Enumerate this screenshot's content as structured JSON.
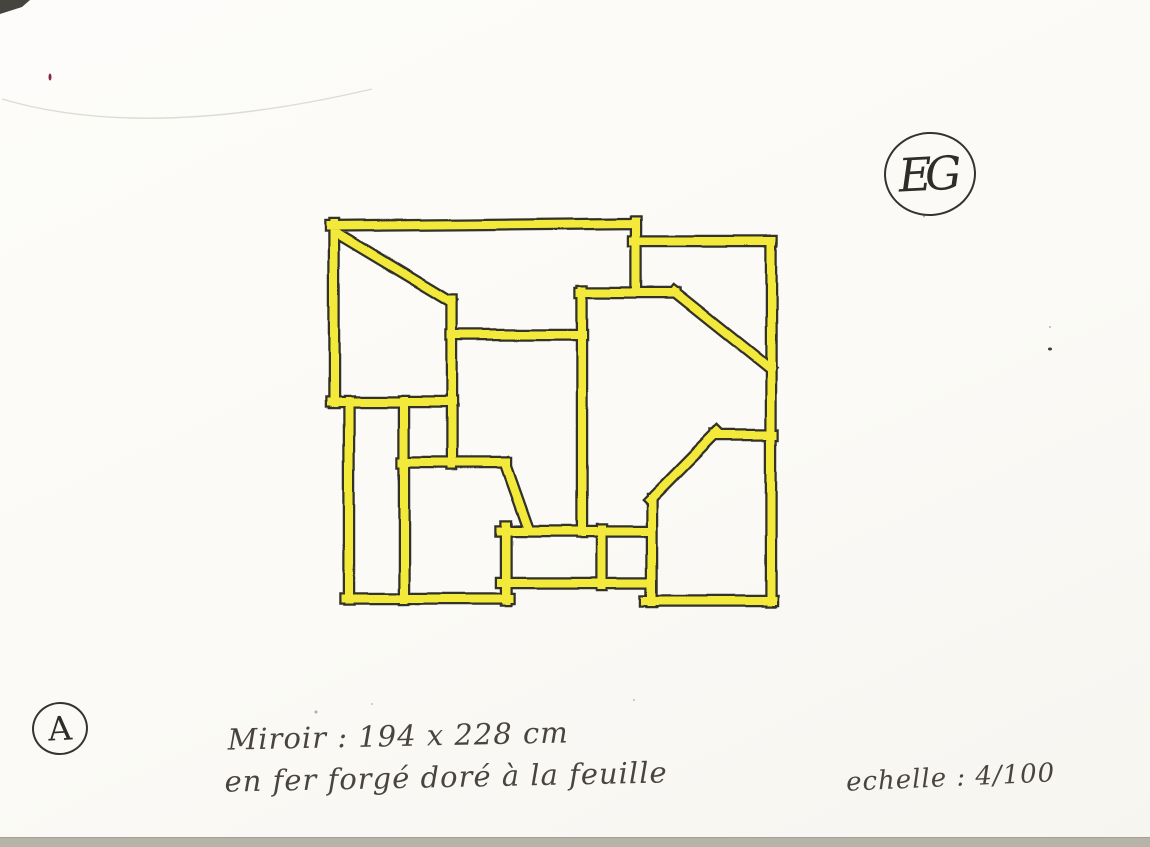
{
  "drawing": {
    "subject": "mirror-frame-design-sketch",
    "frame_color": "#f3e93a",
    "outline_color": "#33312b",
    "segments": [
      [
        334,
        224,
        334,
        403
      ],
      [
        349,
        401,
        349,
        600
      ],
      [
        330,
        226,
        637,
        223
      ],
      [
        637,
        221,
        637,
        293
      ],
      [
        634,
        241,
        772,
        241
      ],
      [
        771,
        241,
        771,
        602
      ],
      [
        773,
        601,
        646,
        601
      ],
      [
        652,
        602,
        652,
        499
      ],
      [
        650,
        500,
        717,
        432
      ],
      [
        715,
        435,
        773,
        435
      ],
      [
        345,
        599,
        509,
        599
      ],
      [
        501,
        583,
        650,
        583
      ],
      [
        506,
        526,
        506,
        601
      ],
      [
        501,
        531,
        650,
        531
      ],
      [
        602,
        529,
        602,
        585
      ],
      [
        338,
        234,
        451,
        302
      ],
      [
        452,
        300,
        452,
        465
      ],
      [
        331,
        402,
        453,
        402
      ],
      [
        404,
        401,
        404,
        600
      ],
      [
        402,
        463,
        506,
        463
      ],
      [
        505,
        464,
        528,
        529
      ],
      [
        451,
        335,
        583,
        335
      ],
      [
        582,
        291,
        582,
        532
      ],
      [
        580,
        293,
        676,
        293
      ],
      [
        675,
        292,
        770,
        368
      ]
    ]
  },
  "annotations": {
    "dimensions_line": "Miroir : 194 x 228 cm",
    "material_line": "en fer forgé doré à la feuille",
    "scale_line": "echelle : 4/100"
  },
  "monogram": {
    "label": "EG"
  },
  "sheet_label": {
    "label": "A"
  },
  "paper": {
    "background": "#fcfbf8",
    "scan_strip_color": "#b6b3a9",
    "corner_mark_color": "#46443f",
    "crease_color": "#dedbd3",
    "specks": [
      {
        "x": 50,
        "y": 77,
        "w": 3,
        "h": 7,
        "color": "#8c2742"
      },
      {
        "x": 316,
        "y": 712,
        "w": 3,
        "h": 3,
        "color": "#b1aea7"
      },
      {
        "x": 1050,
        "y": 349,
        "w": 4,
        "h": 3,
        "color": "#3a3a37"
      },
      {
        "x": 1050,
        "y": 327,
        "w": 2,
        "h": 2,
        "color": "#b8b5ae"
      },
      {
        "x": 634,
        "y": 700,
        "w": 2,
        "h": 2,
        "color": "#c0bdb6"
      },
      {
        "x": 924,
        "y": 216,
        "w": 2,
        "h": 3,
        "color": "#b5b2ac"
      },
      {
        "x": 372,
        "y": 704,
        "w": 2,
        "h": 2,
        "color": "#c4c1ba"
      }
    ]
  }
}
